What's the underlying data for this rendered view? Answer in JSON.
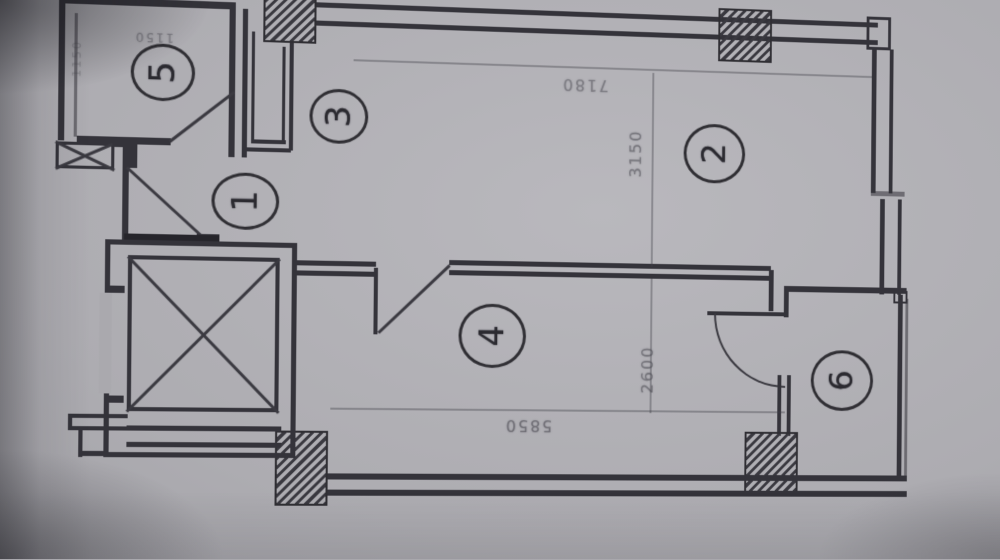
{
  "photo": {
    "paper_color": "#adacb1",
    "line_color": "#34333a",
    "description": "photographed architectural floor plan, rotated 90deg CCW with keystone tilt"
  },
  "plan": {
    "room_markers": [
      {
        "number": "1",
        "x": 247,
        "y": 207,
        "rx": 33,
        "ry": 28,
        "rot": -90
      },
      {
        "number": "2",
        "x": 719,
        "y": 148,
        "rx": 32,
        "ry": 30,
        "rot": -90
      },
      {
        "number": "3",
        "x": 338,
        "y": 121,
        "rx": 29,
        "ry": 27,
        "rot": -90
      },
      {
        "number": "4",
        "x": 493,
        "y": 336,
        "rx": 34,
        "ry": 32,
        "rot": -90
      },
      {
        "number": "5",
        "x": 166,
        "y": 83,
        "rx": 31,
        "ry": 28,
        "rot": -90
      },
      {
        "number": "6",
        "x": 855,
        "y": 377,
        "rx": 33,
        "ry": 31,
        "rot": -90
      }
    ],
    "dimensions": [
      {
        "text": "7180",
        "x": 585,
        "y": 82,
        "rot": 180,
        "size": 16,
        "opacity": 0.5
      },
      {
        "text": "3150",
        "x": 637,
        "y": 150,
        "rot": -90,
        "size": 16,
        "opacity": 0.55
      },
      {
        "text": "2600",
        "x": 651,
        "y": 368,
        "rot": -90,
        "size": 16,
        "opacity": 0.55
      },
      {
        "text": "5850",
        "x": 530,
        "y": 425,
        "rot": 180,
        "size": 16,
        "opacity": 0.6
      },
      {
        "text": "1150",
        "x": 157,
        "y": 49,
        "rot": 180,
        "size": 12,
        "opacity": 0.45
      },
      {
        "text": "1150",
        "x": 83,
        "y": 72,
        "rot": -90,
        "size": 11,
        "opacity": 0.3
      }
    ]
  }
}
